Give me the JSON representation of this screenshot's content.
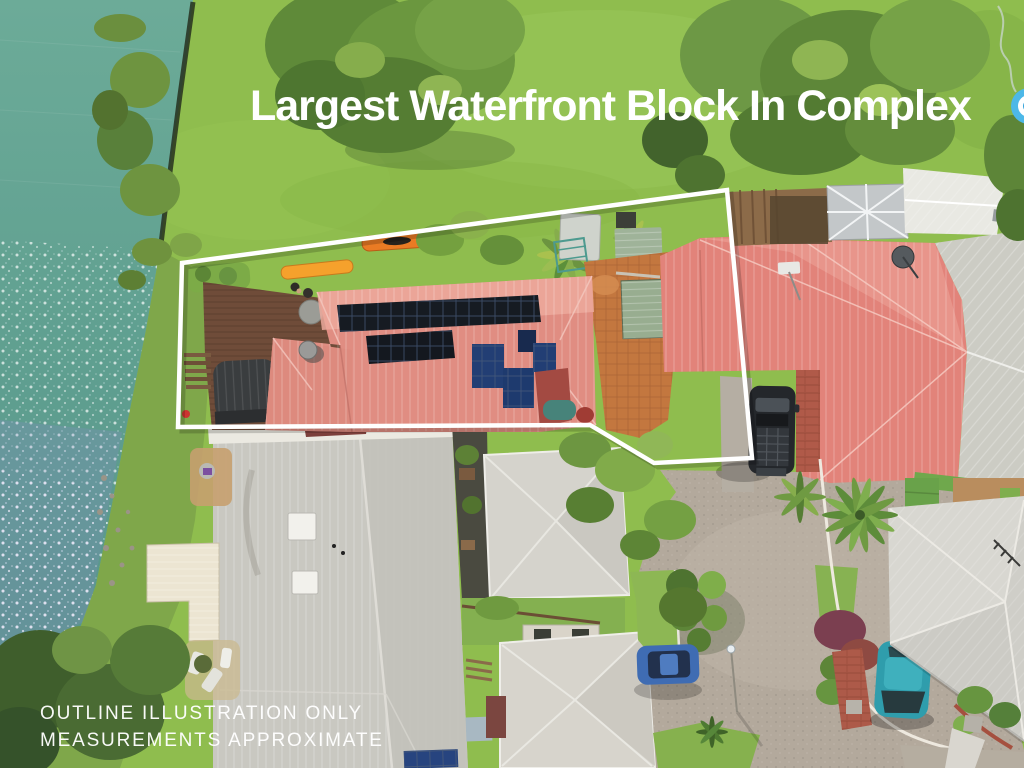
{
  "overlay": {
    "headline": "Largest Waterfront Block In Complex",
    "disclaimer": [
      "OUTLINE ILLUSTRATION ONLY",
      "MEASUREMENTS APPROXIMATE"
    ],
    "logo": {
      "name": "partial-blue-circle-badge",
      "color_outer": "#4db8e8",
      "color_inner": "#2d9fd8"
    }
  },
  "palette": {
    "water": "#5f9f90",
    "water_sparkle": "#ffffff",
    "water_glint_tint": "#8f86d8",
    "lawn": "#8fbd4e",
    "tree_dark": "#557d33",
    "tree_light": "#86ad4c",
    "main_roof_salmon": "#e08d82",
    "neighbor_roof_red": "#e2837a",
    "gray_roof": "#cbc9c2",
    "cream_roof": "#ece5d2",
    "deck_timber": "#6f4c39",
    "terracotta_path": "#c3773f",
    "driveway_concrete": "#b3a99c",
    "brick_paving": "#ad5a49",
    "solar_black": "#161b22",
    "solar_blue": "#223e74",
    "kayak_orange": "#ef8f2e",
    "suv_black": "#24272b",
    "car_blue": "#3f6cb3",
    "car_teal": "#2f9dac",
    "outline_white": "#ffffff"
  },
  "scene": {
    "features": [
      "waterfront-canal",
      "shoreline-fence",
      "timber-deck",
      "two-kayaks",
      "property-boundary-outline",
      "salmon-roof-house",
      "solar-panel-arrays",
      "satellite-dishes",
      "garden-sheds",
      "neighbor-red-roof-house",
      "gray-metal-roofs",
      "dark-suv",
      "blue-sedan",
      "teal-hatchback",
      "shared-driveway",
      "round-hedges",
      "large-trees",
      "lawn"
    ]
  }
}
